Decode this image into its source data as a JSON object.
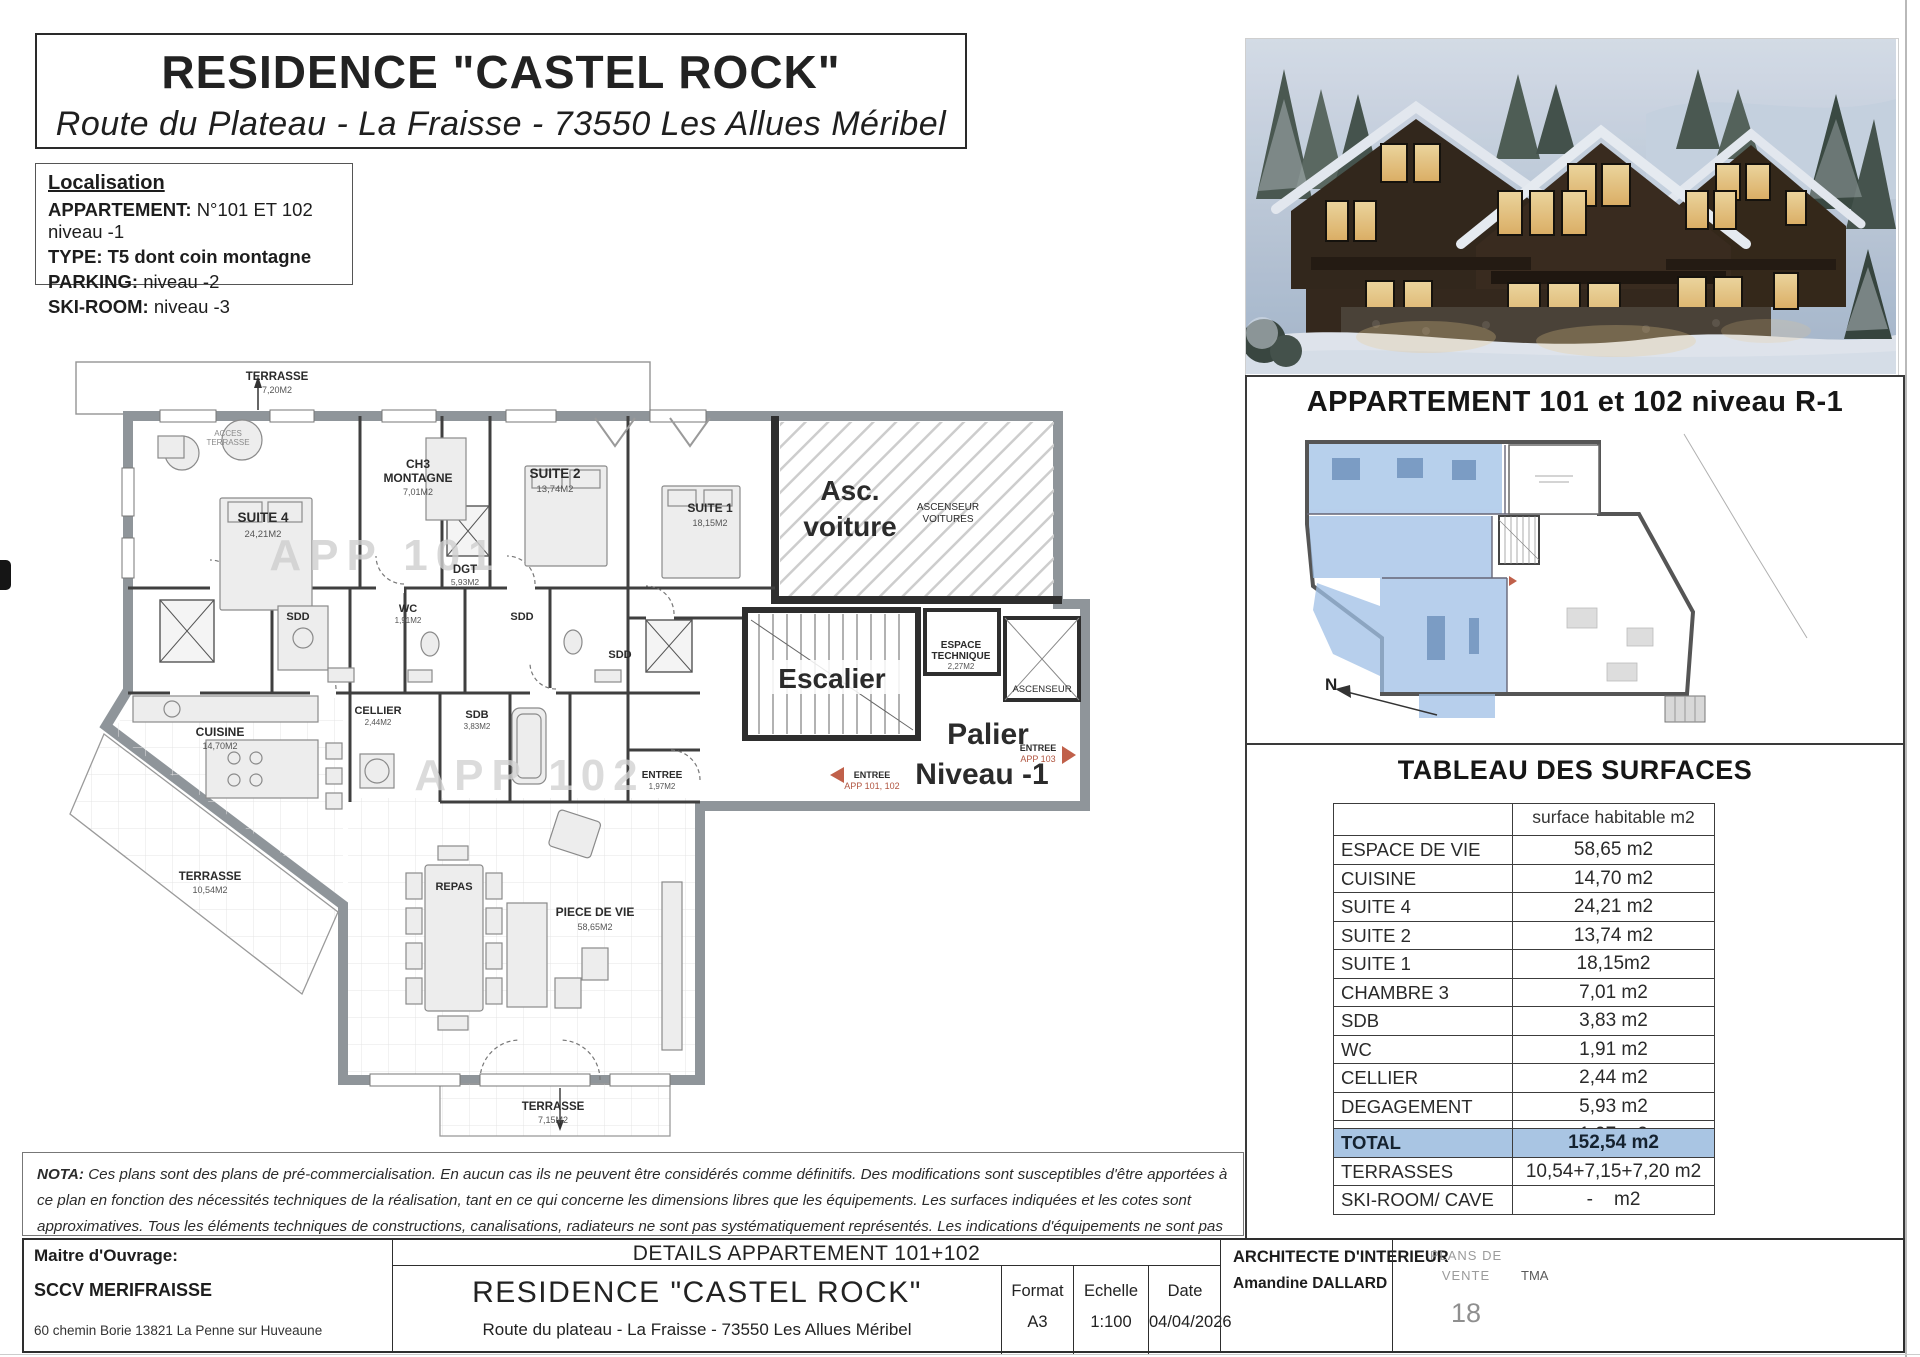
{
  "header": {
    "title": "RESIDENCE \"CASTEL ROCK\"",
    "subtitle": "Route du Plateau - La Fraisse - 73550 Les Allues Méribel"
  },
  "localisation": {
    "title": "Localisation",
    "appartement_label": "APPARTEMENT:",
    "appartement_value": "N°101 ET 102  niveau -1",
    "type_label": "TYPE:",
    "type_value": "T5 dont coin montagne",
    "parking_label": "PARKING:",
    "parking_value": "niveau -2",
    "skiroom_label": "SKI-ROOM:",
    "skiroom_value": "niveau -3"
  },
  "plan": {
    "watermark_app101": "APP 101",
    "watermark_app102": "APP 102",
    "rooms": {
      "terrasse_top": {
        "name": "TERRASSE",
        "area": "7,20M2"
      },
      "acces_terrasse": {
        "l1": "ACCES",
        "l2": "TERRASSE"
      },
      "suite4": {
        "name": "SUITE 4",
        "area": "24,21M2"
      },
      "ch3": {
        "l1": "CH3",
        "l2": "MONTAGNE",
        "area": "7,01M2"
      },
      "suite2": {
        "name": "SUITE 2",
        "area": "13,74M2"
      },
      "suite1": {
        "name": "SUITE 1",
        "area": "18,15M2"
      },
      "asc_voiture": {
        "l1": "Asc.",
        "l2": "voiture",
        "s1": "ASCENSEUR",
        "s2": "VOITURES"
      },
      "dgt": {
        "name": "DGT",
        "area": "5,93M2"
      },
      "sdd_a": {
        "name": "SDD"
      },
      "sdd_b": {
        "name": "SDD"
      },
      "sdd_c": {
        "name": "SDD"
      },
      "wc": {
        "name": "WC",
        "area": "1,91M2"
      },
      "cellier": {
        "name": "CELLIER",
        "area": "2,44M2"
      },
      "sdb": {
        "name": "SDB",
        "area": "3,83M2"
      },
      "cuisine": {
        "name": "CUISINE",
        "area": "14,70M2"
      },
      "escalier": {
        "name": "Escalier"
      },
      "espace_technique": {
        "l1": "ESPACE",
        "l2": "TECHNIQUE",
        "area": "2,27M2"
      },
      "ascenseur": {
        "name": "ASCENSEUR"
      },
      "palier": {
        "l1": "Palier",
        "l2": "Niveau -1"
      },
      "entree": {
        "name": "ENTREE",
        "area": "1,97M2"
      },
      "entree_app103": {
        "l1": "ENTREE",
        "l2": "APP 103"
      },
      "entree_app101_102": {
        "l1": "ENTREE",
        "l2": "APP 101, 102"
      },
      "repas": {
        "name": "REPAS"
      },
      "piece_de_vie": {
        "name": "PIECE DE VIE",
        "area": "58,65M2"
      },
      "terrasse_left": {
        "name": "TERRASSE",
        "area": "10,54M2"
      },
      "terrasse_bottom": {
        "name": "TERRASSE",
        "area": "7,15M2"
      }
    }
  },
  "right": {
    "plan_title": "APPARTEMENT 101 et 102 niveau R-1",
    "table_title": "TABLEAU DES SURFACES"
  },
  "mini_plan": {
    "north": "N"
  },
  "surface_table": {
    "header": "surface habitable m2",
    "rows": [
      [
        "ESPACE DE VIE",
        "58,65 m2"
      ],
      [
        "CUISINE",
        "14,70 m2"
      ],
      [
        "SUITE 4",
        "24,21 m2"
      ],
      [
        "SUITE  2",
        "13,74 m2"
      ],
      [
        "SUITE 1",
        "18,15m2"
      ],
      [
        "CHAMBRE 3",
        "7,01 m2"
      ],
      [
        "SDB",
        "3,83 m2"
      ],
      [
        "WC",
        "1,91 m2"
      ],
      [
        "CELLIER",
        "2,44 m2"
      ],
      [
        "DEGAGEMENT",
        "5,93 m2"
      ],
      [
        "ENTREE",
        "1,97 m2"
      ]
    ],
    "totals": [
      [
        "TOTAL",
        "152,54 m2"
      ],
      [
        "TERRASSES",
        "10,54+7,15+7,20 m2"
      ],
      [
        "SKI-ROOM/ CAVE",
        "-    m2"
      ]
    ]
  },
  "nota": {
    "label": "NOTA:",
    "text": " Ces plans sont des plans de pré-commercialisation. En aucun cas ils ne peuvent être considérés comme définitifs. Des modifications sont susceptibles d'être apportées à ce plan en fonction des nécessités techniques de la réalisation, tant en ce qui concerne les dimensions libres que les équipements. Les surfaces indiquées et les cotes sont approximatives. Tous les éléments techniques de constructions, canalisations, radiateurs ne sont pas systématiquement représentés. Les indications d'équipements ne sont pas contractuelles."
  },
  "titleblock": {
    "maitre_label": "Maitre d'Ouvrage:",
    "maitre_name": "SCCV MERIFRAISSE",
    "maitre_address": "60 chemin Borie 13821 La Penne sur Huveaune",
    "details_title": "DETAILS APPARTEMENT 101+102",
    "residence": "RESIDENCE  \"CASTEL ROCK\"",
    "residence_address": "Route du plateau - La Fraisse - 73550 Les Allues Méribel",
    "format_label": "Format",
    "format_value": "A3",
    "echelle_label": "Echelle",
    "echelle_value": "1:100",
    "date_label": "Date",
    "date_value": "04/04/2026",
    "architecte_label": "ARCHITECTE D'INTERIEUR",
    "architecte_name": "Amandine DALLARD",
    "plans_de": "PLANS DE",
    "vente": "VENTE",
    "tma": "TMA",
    "page": "18"
  }
}
